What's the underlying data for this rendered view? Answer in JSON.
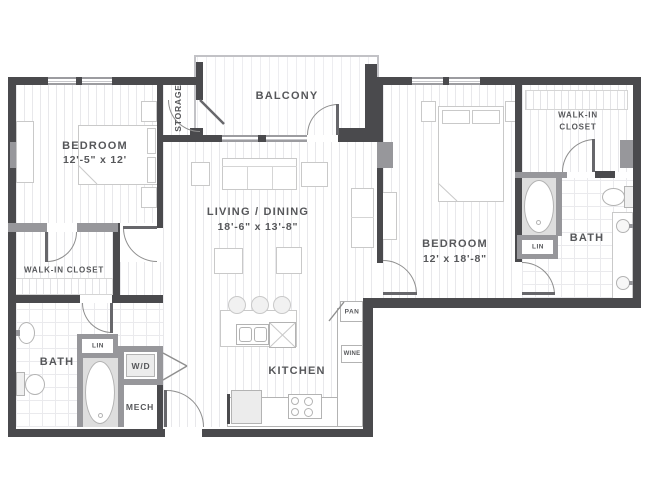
{
  "labels": {
    "bedroom1": {
      "name": "BEDROOM",
      "dims": "12'-5\" x 12'"
    },
    "living": {
      "name": "LIVING / DINING",
      "dims": "18'-6\" x 13'-8\""
    },
    "bedroom2": {
      "name": "BEDROOM",
      "dims": "12' x 18'-8\""
    },
    "kitchen": "KITCHEN",
    "balcony": "BALCONY",
    "storage": "STORAGE",
    "walkin_left": "WALK-IN CLOSET",
    "walkin_right": {
      "line1": "WALK-IN",
      "line2": "CLOSET"
    },
    "bath_left": "BATH",
    "bath_right": "BATH",
    "linen_left": "LIN",
    "linen_right": "LIN",
    "washer_dryer": "W/D",
    "mechanical": "MECH",
    "pantry": "PAN",
    "wine": "WINE"
  },
  "colors": {
    "wall": "#4a4a4d",
    "partition": "#97979b",
    "fixture_outline": "#c9c9c9",
    "label_text": "#56575a",
    "floor_line": "#e8e8eb",
    "light_fill": "#dedede"
  }
}
